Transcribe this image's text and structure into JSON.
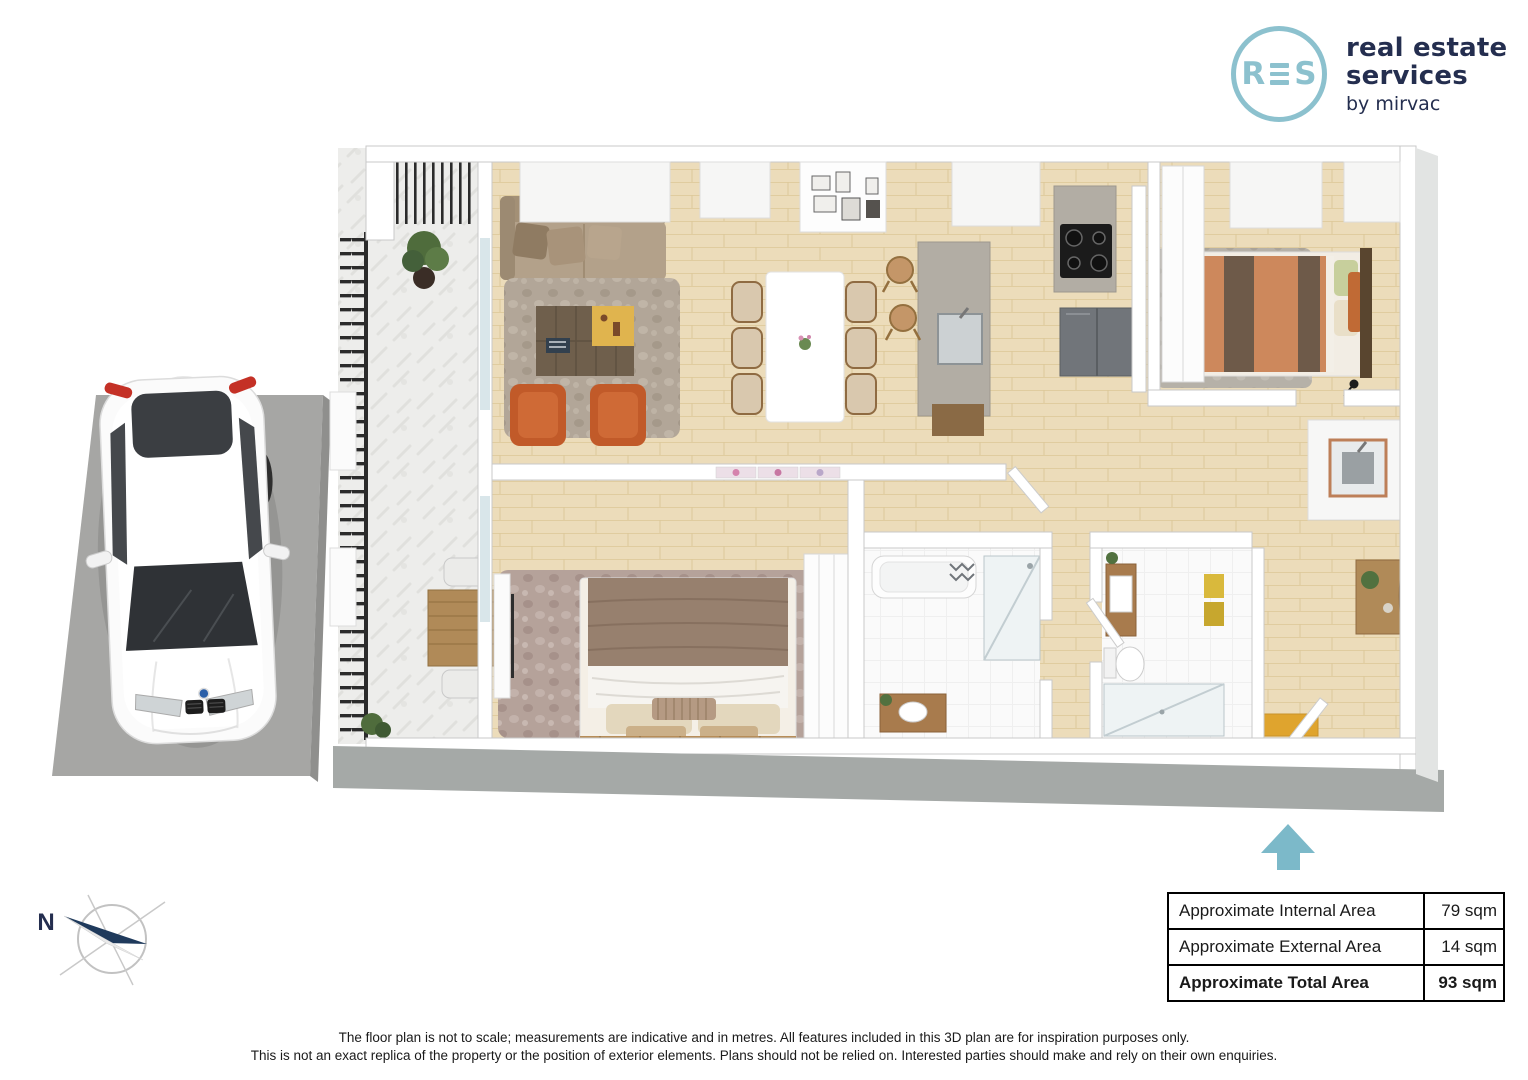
{
  "logo": {
    "monogram_left": "R",
    "monogram_right": "S",
    "line1": "real estate",
    "line2": "services",
    "byline": "by mirvac"
  },
  "compass": {
    "north_label": "N"
  },
  "area_table": {
    "rows": [
      {
        "label": "Approximate Internal Area",
        "value": "79 sqm"
      },
      {
        "label": "Approximate External Area",
        "value": "14 sqm"
      },
      {
        "label": "Approximate Total Area",
        "value": "93 sqm"
      }
    ]
  },
  "disclaimer": {
    "line1": "The floor plan is not to scale; measurements are indicative and in metres. All features included in this 3D plan are for inspiration purposes only.",
    "line2": "This is not an exact replica of the property or the position of exterior elements. Plans should not be relied on. Interested parties should make and rely on their own enquiries."
  },
  "colors": {
    "brand_teal": "#8cc1ce",
    "brand_navy": "#242e4f",
    "entry_arrow": "#7cb9c9",
    "table_border": "#000000",
    "accent_orange": "#c15a29",
    "wood": "#ecdcba"
  }
}
